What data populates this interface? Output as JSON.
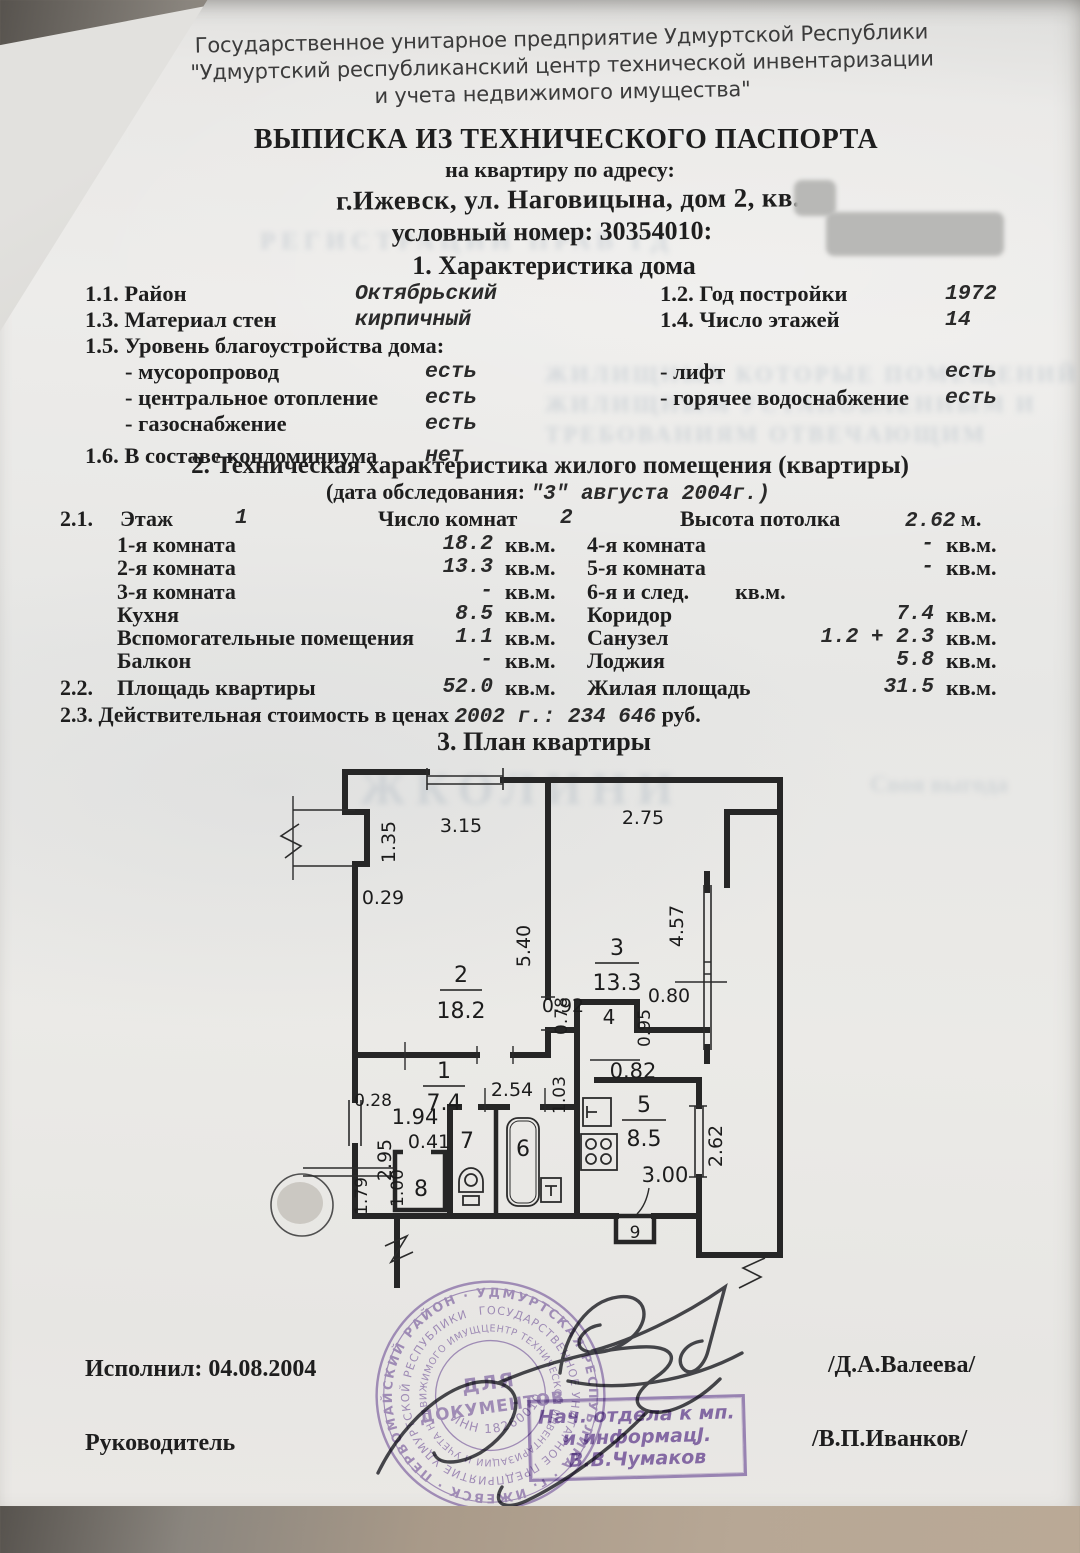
{
  "org_header": {
    "line1": "Государственное унитарное предприятие Удмуртской Республики",
    "line2": "\"Удмуртский республиканский центр технической инвентаризации",
    "line3": "и учета недвижимого имущества\""
  },
  "doc": {
    "title": "ВЫПИСКА ИЗ ТЕХНИЧЕСКОГО ПАСПОРТА",
    "subtitle": "на квартиру по адресу:",
    "address": "г.Ижевск, ул. Наговицына, дом 2, кв.",
    "conditional_number": "условный номер: 30354010:"
  },
  "section1": {
    "heading": "1. Характеристика дома",
    "r1": {
      "n": "1.1.",
      "label": "Район",
      "value": "Октябрьский",
      "n2": "1.2.",
      "label2": "Год постройки",
      "value2": "1972"
    },
    "r2": {
      "n": "1.3.",
      "label": "Материал стен",
      "value": "кирпичный",
      "n2": "1.4.",
      "label2": "Число этажей",
      "value2": "14"
    },
    "amenities_heading": "1.5. Уровень благоустройства дома:",
    "a1": {
      "label": "- мусоропровод",
      "value": "есть",
      "label2": "- лифт",
      "value2": "есть"
    },
    "a2": {
      "label": "- центральное отопление",
      "value": "есть",
      "label2": "- горячее водоснабжение",
      "value2": "есть"
    },
    "a3": {
      "label": "- газоснабжение",
      "value": "есть"
    },
    "r6": {
      "n": "1.6.",
      "label": "В составе кондоминиума",
      "value": "нет"
    }
  },
  "section2": {
    "heading": "2. Техническая характеристика жилого помещения (квартиры)",
    "date_prefix": "(дата обследования:",
    "date_value": "\"3\" августа 2004г.)",
    "r21": {
      "n": "2.1.",
      "l1": "Этаж",
      "v1": "1",
      "l2": "Число комнат",
      "v2": "2",
      "l3": "Высота потолка",
      "v3": "2.62",
      "u3": "м."
    },
    "rooms": [
      {
        "label": "1-я комната",
        "value": "18.2",
        "unit": "кв.м.",
        "label2": "4-я комната",
        "value2": "-",
        "unit2": "кв.м."
      },
      {
        "label": "2-я комната",
        "value": "13.3",
        "unit": "кв.м.",
        "label2": "5-я комната",
        "value2": "-",
        "unit2": "кв.м."
      },
      {
        "label": "3-я комната",
        "value": "-",
        "unit": "кв.м.",
        "label2": "6-я и след.",
        "value2": "",
        "unit2": "кв.м."
      },
      {
        "label": "Кухня",
        "value": "8.5",
        "unit": "кв.м.",
        "label2": "Коридор",
        "value2": "7.4",
        "unit2": "кв.м."
      },
      {
        "label": "Вспомогательные помещения",
        "value": "1.1",
        "unit": "кв.м.",
        "label2": "Санузел",
        "value2": "1.2 + 2.3",
        "unit2": "кв.м."
      },
      {
        "label": "Балкон",
        "value": "-",
        "unit": "кв.м.",
        "label2": "Лоджия",
        "value2": "5.8",
        "unit2": "кв.м."
      }
    ],
    "r22": {
      "n": "2.2.",
      "label": "Площадь квартиры",
      "value": "52.0",
      "unit": "кв.м.",
      "label2": "Жилая площадь",
      "value2": "31.5",
      "unit2": "кв.м."
    },
    "r23": {
      "n": "2.3.",
      "label": "Действительная стоимость в ценах",
      "value_mono": "2002 г.: 234 646",
      "suffix": "руб."
    }
  },
  "plan": {
    "heading": "3. План квартиры",
    "rooms": {
      "room1_num": "1",
      "room1_area": "7.4",
      "room2_num": "2",
      "room2_area": "18.2",
      "room3_num": "3",
      "room3_area": "13.3",
      "room4_num": "4",
      "room5_num": "5",
      "room5_area": "8.5",
      "room6_num": "6",
      "room7_num": "7",
      "room8_num": "8",
      "vent_label": "9"
    },
    "dims": {
      "dim_135": "1.35",
      "dim_315": "3.15",
      "dim_275": "2.75",
      "dim_029": "0.29",
      "dim_540": "5.40",
      "dim_457": "4.57",
      "dim_092": "0.92",
      "dim_078": "0.78",
      "dim_080": "0.80",
      "dim_095": "0.95",
      "dim_103": "1.03",
      "dim_082": "0.82",
      "dim_254": "2.54",
      "dim_028": "0.28",
      "dim_194": "1.94",
      "dim_041": "0.41",
      "dim_295": "2.95",
      "dim_100": "1.00",
      "dim_179": "1.79",
      "dim_300": "3.00",
      "dim_262": "2.62"
    }
  },
  "footer": {
    "executed_label": "Исполнил: 04.08.2004",
    "executor_name": "/Д.А.Валеева/",
    "head_label": "Руководитель",
    "head_name": "/В.П.Иванков/"
  },
  "stamps": {
    "round": {
      "ring_outer": "УДМУРТСКАЯ РЕСПУБЛИКА · г. ИЖЕВСК · ПЕРВОМАЙСКИЙ РАЙОН ·",
      "ring_middle": "ГОСУДАРСТВЕННОЕ УНИТАРНОЕ ПРЕДПРИЯТИЕ УДМУРТСКОЙ РЕСПУБЛИКИ",
      "ring_inner": "ЦЕНТР ТЕХНИЧЕСКОЙ ИНВЕНТАРИЗАЦИИ И УЧЕТА НЕДВИЖИМОГО ИМУЩЕСТВА",
      "inn": "ИНН 1826001013",
      "center1": "ДЛЯ",
      "center2": "ДОКУМЕНТОВ"
    },
    "rect": {
      "line1": "Нач. отдела к  мп.",
      "line2": "и информацЈ.",
      "line3": "В.В.Чумаков"
    }
  },
  "artifacts": {
    "ghost": {
      "band1": "РЕГИСТРАЦИИ ПРАВ ГД",
      "block1": "ЖИЛИЩНЫХ КОТОРЫЕ ПОМЕЩЕНИЙ",
      "block2": "ЖИЛИЩНЫМ УСТАНОВЛЕННЫМ И",
      "block3": "ТРЕБОВАНИЯМ ОТВЕЧАЮЩИМ",
      "plan1": "ЖКОЛИНИ",
      "plan2": "Своя выгода"
    }
  }
}
